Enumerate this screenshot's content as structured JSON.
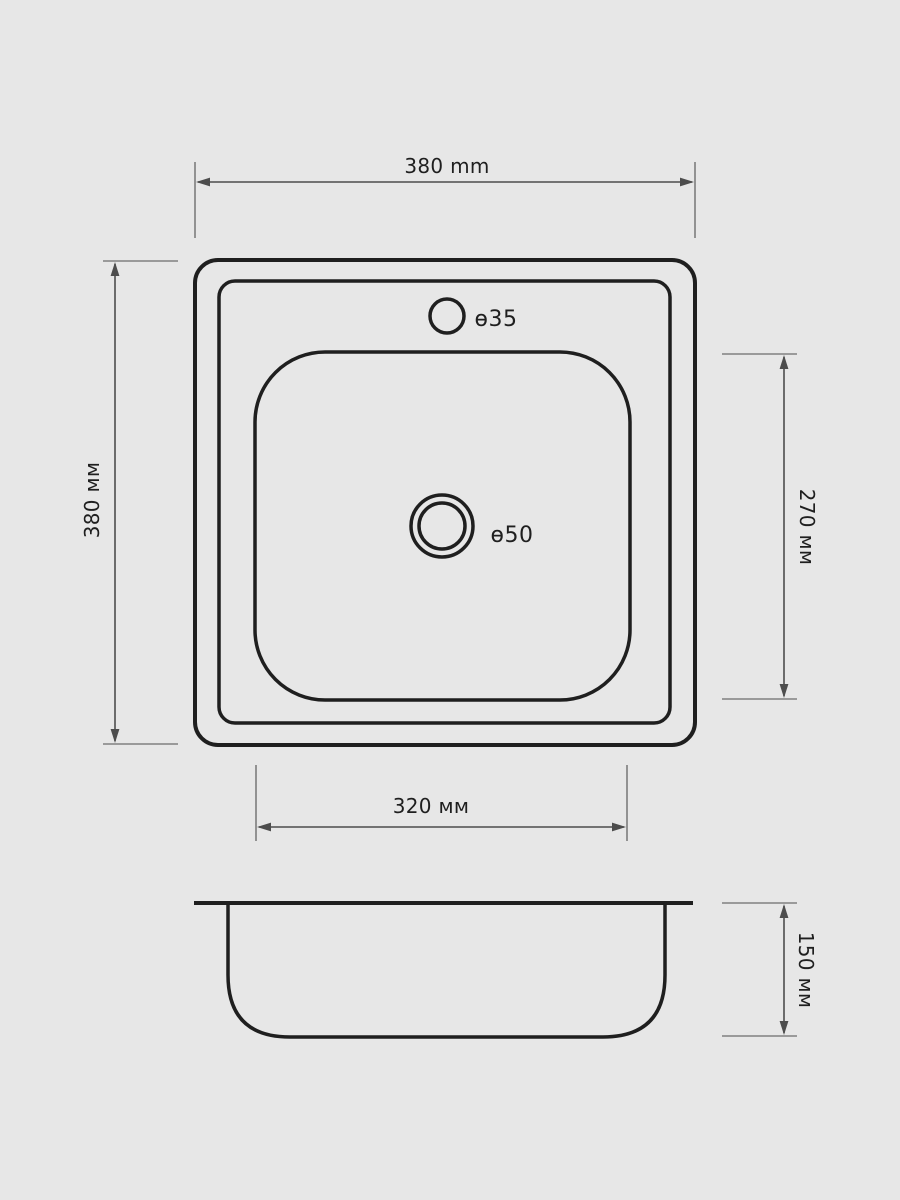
{
  "colors": {
    "background": "#e7e7e7",
    "outline": "#1f1f1f",
    "dimension": "#4d4d4d",
    "text": "#1f1f1f"
  },
  "labels": {
    "faucet_hole": "ɵ35",
    "drain_hole": "ɵ50"
  },
  "dimensions": {
    "overall_width": "380 mm",
    "overall_depth": "380 мм",
    "bowl_inner_depth": "270 мм",
    "bowl_inner_width": "320 мм",
    "bowl_height": "150 мм"
  }
}
